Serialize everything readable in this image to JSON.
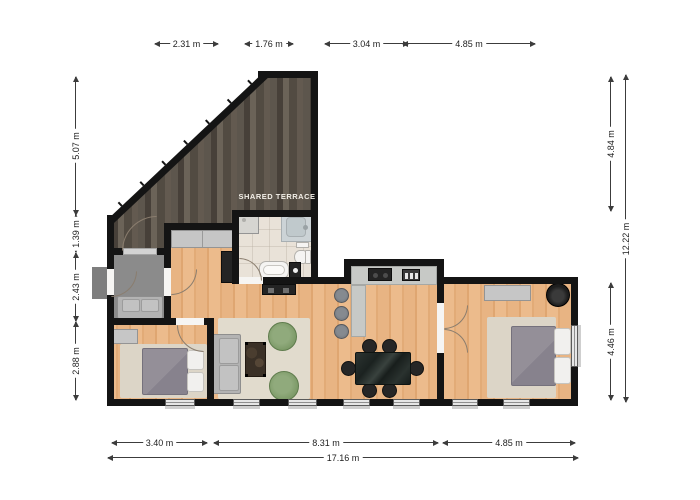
{
  "floorplan": {
    "terrace_label": "SHARED TERRACE",
    "rooms": [
      "shared terrace",
      "entry hall",
      "hallway",
      "bathroom",
      "kitchen",
      "living room",
      "dining area",
      "bedroom left",
      "bedroom right"
    ]
  },
  "dims": {
    "top": [
      "2.31 m",
      "1.76 m",
      "3.04 m",
      "4.85 m"
    ],
    "left": [
      "5.07 m",
      "1.39 m",
      "2.43 m",
      "2.88 m"
    ],
    "right": [
      "4.84 m",
      "4.46 m"
    ],
    "right_total": "12.22 m",
    "bottom": [
      "3.40 m",
      "8.31 m",
      "4.85 m"
    ],
    "bottom_total": "17.16 m"
  },
  "colors": {
    "wall": "#141414",
    "wood_floor": "#e8b483",
    "terrace_floor": "#564f47",
    "bathroom_floor": "#e9e2d8",
    "entry_floor": "#8b8b8b",
    "rug": "#e1dbcd",
    "armchair_green": "#7d9a68",
    "duvet_gray": "#8e8b94",
    "dimension_text": "#1e1e1e"
  }
}
